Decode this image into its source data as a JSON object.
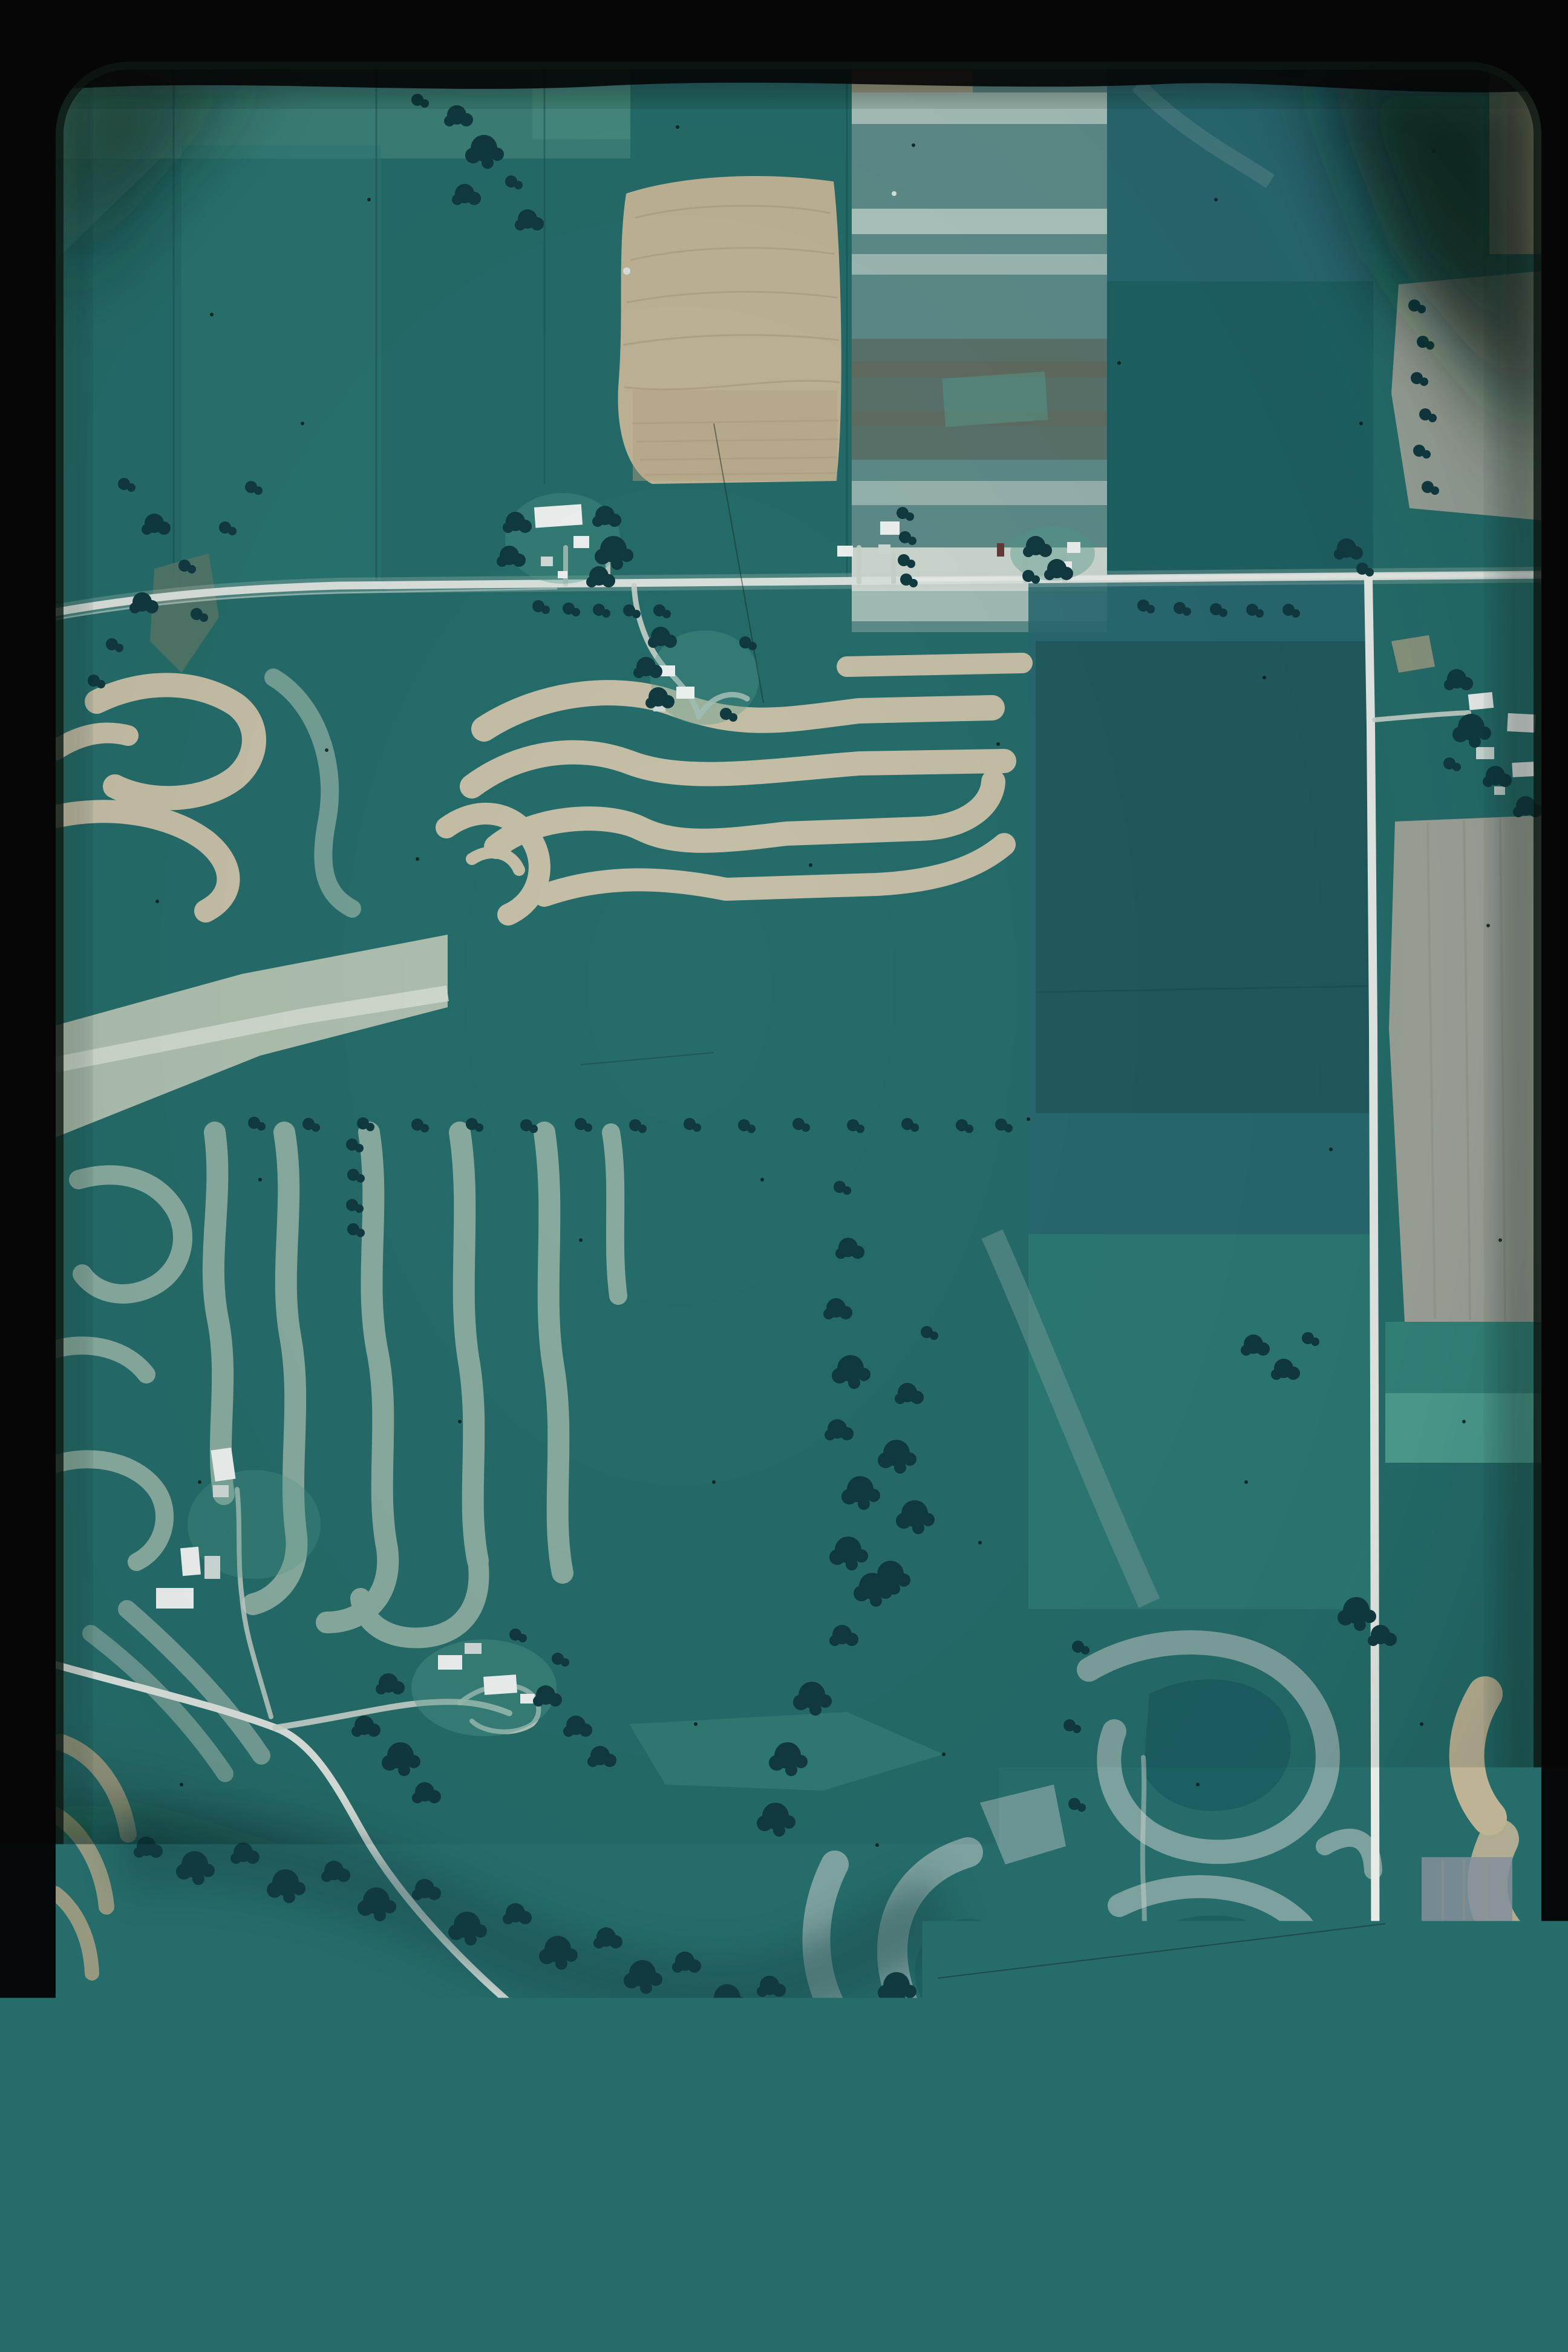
{
  "scene": {
    "kind": "35mm color film slide of a vertical aerial photograph",
    "subject": "contour strip-cropped farmland with roads, farmsteads and woodlots",
    "roads": [
      "east-west-highway",
      "north-south-county-road",
      "bottom-section-road",
      "southwest-farm-road"
    ],
    "farmstead_count": 7,
    "frame": "black slide border with rounded photo corners and dark corner vignettes"
  },
  "palette": {
    "black": "#060606",
    "border_shadow": "#0d1712",
    "photo_tint": "#0e3f44",
    "teal_base": "#27706d",
    "teal_light": "#2f7d77",
    "teal_pale": "#3f8c82",
    "teal_dark": "#1e6164",
    "teal_deep": "#174f54",
    "blue_field": "#2b6b73",
    "field_dark_rect": "#235d60",
    "aqua_strip": "#37897e",
    "aqua_bright": "#58ab99",
    "wash_green": "#5da08f",
    "stripe_field": "#63928e",
    "stripe_pale": "#b9cec7",
    "stripe_bright": "#d9e3d8",
    "olive_band": "#5f7269",
    "tan_field": "#cdbd9c",
    "tan_rows": "#b8a785",
    "tan_deep": "#c0ae8b",
    "cream_strip": "#d3c9ae",
    "pale_band": "#c2cdbb",
    "band_white": "#e6ebdd",
    "sage_strip": "#92b4a6",
    "grey_curl": "#86a9a5",
    "grey_tan_field": "#a9ab9f",
    "grey_tan_rows": "#9a9c90",
    "mauve_field": "#8d96a0",
    "lawn_green": "#55a090",
    "scrub_mauve": "#6e6472",
    "knoll_green": "#74a18e",
    "road_white": "#e9eee7",
    "road_bright": "#f7f9f3",
    "drive_pale": "#d7ded3",
    "building_white": "#fdfefc",
    "building_grey": "#dde6e2",
    "barn_red": "#6b3a36",
    "tree_dark": "#113a40",
    "tree_mid": "#1b4d50",
    "speck_dark": "#0c1b17",
    "speck_light": "#e9efe8",
    "vignette_dark": "#0c1a13",
    "vignette_deep": "#091309",
    "vignette_olive": "#20301a"
  }
}
